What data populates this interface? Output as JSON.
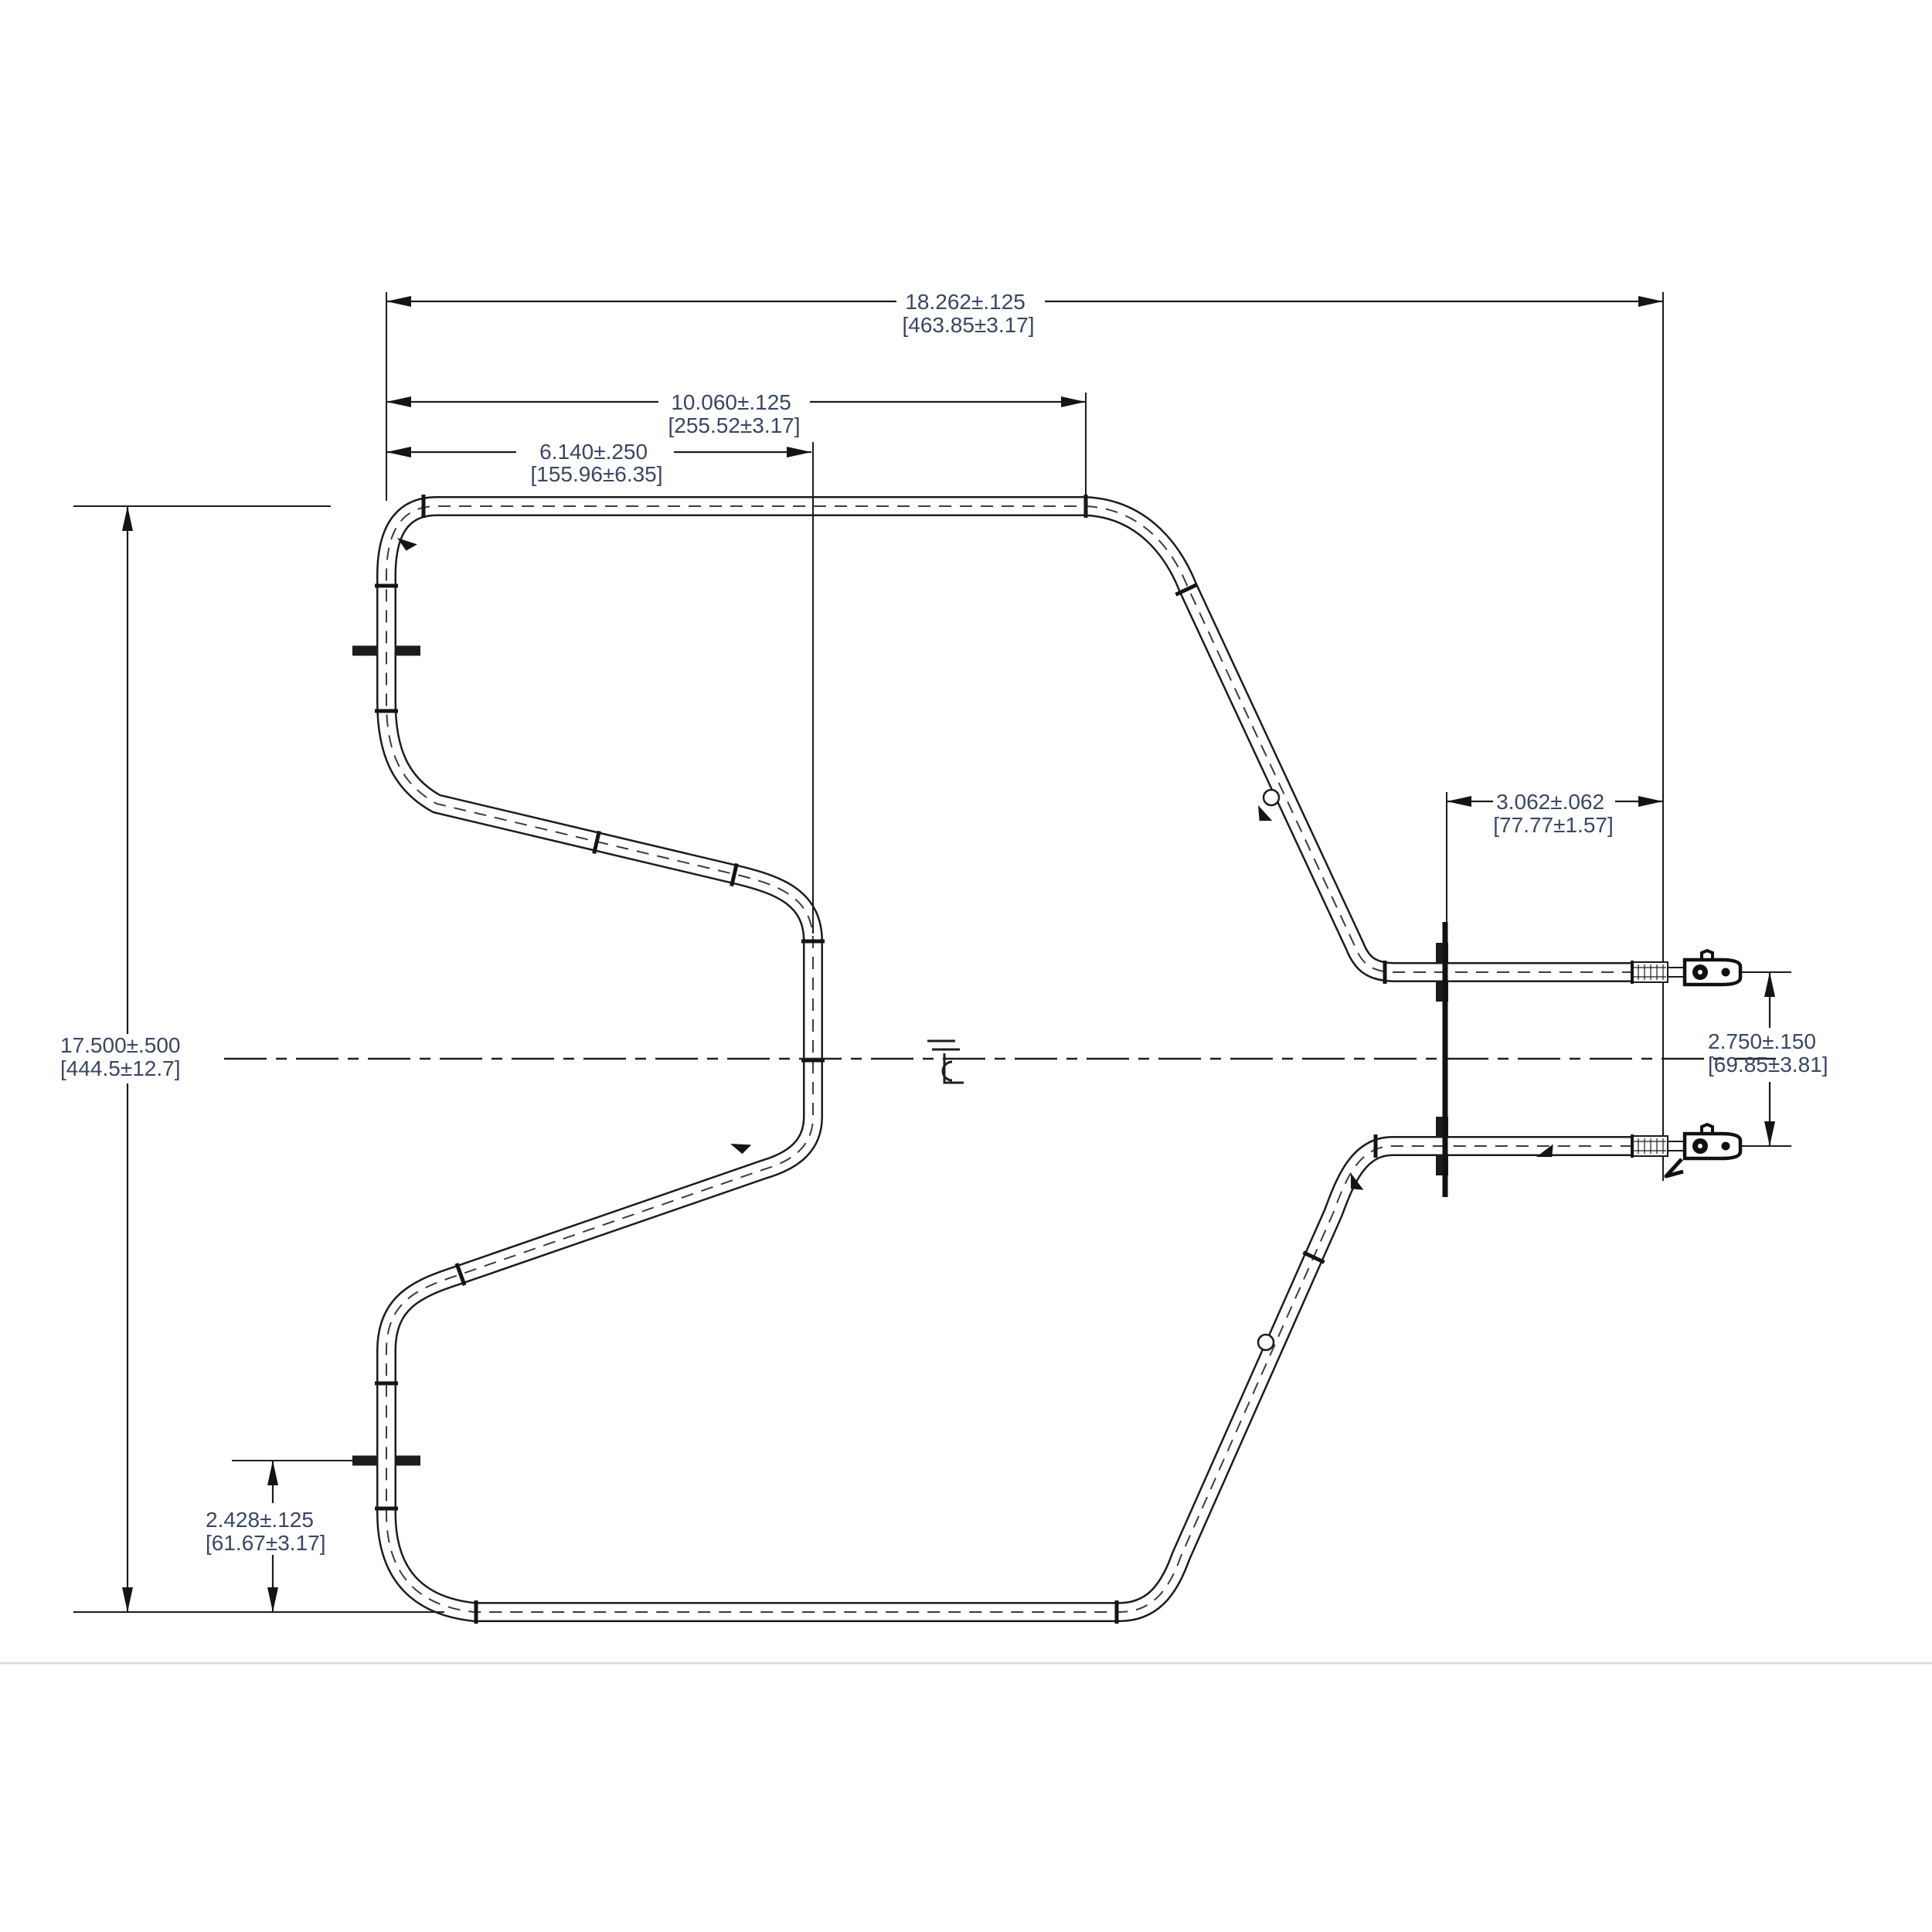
{
  "colors": {
    "line": "#1c1c1c",
    "dim_text": "#3a4565",
    "faint_rule": "#dcdcdc",
    "background": "#ffffff"
  },
  "centerline_symbol": "℄",
  "dimensions": {
    "overall_length": {
      "in": "18.262±.125",
      "mm": "[463.85±3.17]"
    },
    "top_segment": {
      "in": "10.060±.125",
      "mm": "[255.52±3.17]"
    },
    "center_leg": {
      "in": "6.140±.250",
      "mm": "[155.96±6.35]"
    },
    "overall_height": {
      "in": "17.500±.500",
      "mm": "[444.5±12.7]"
    },
    "bracket_offset": {
      "in": "3.062±.062",
      "mm": "[77.77±1.57]"
    },
    "terminal_spacing": {
      "in": "2.750±.150",
      "mm": "[69.85±3.81]"
    },
    "bottom_clip_offset": {
      "in": "2.428±.125",
      "mm": "[61.67±3.17]"
    }
  }
}
